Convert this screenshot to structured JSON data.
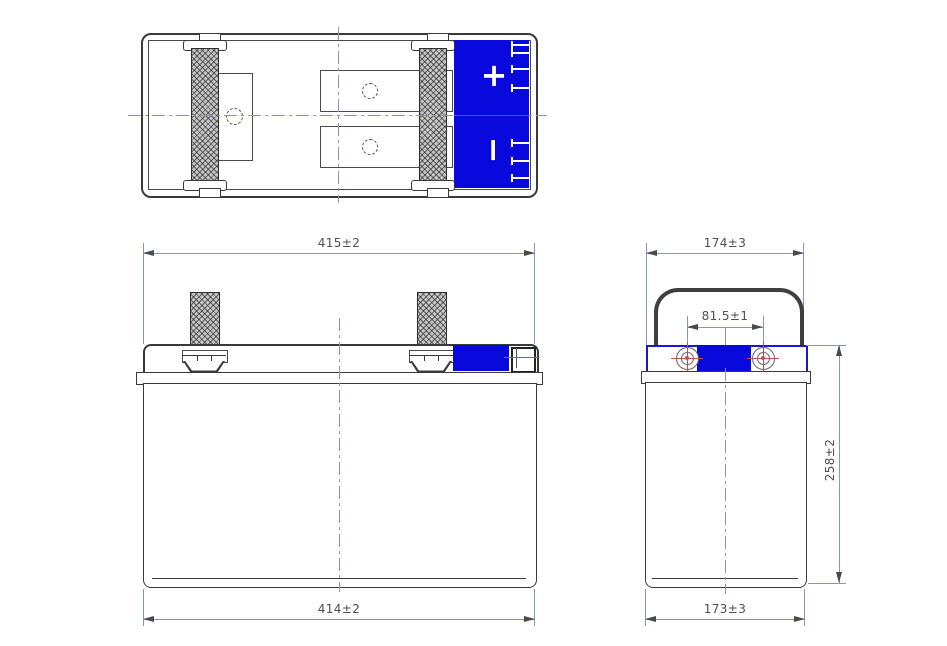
{
  "title": "Battery three-view dimensional drawing",
  "colors": {
    "line": "#3a3a3a",
    "accent_blue": "#0909dd",
    "dimension_line": "#8a92c8",
    "dimension_text": "#4f4f4f",
    "marker_red": "#c0504d"
  },
  "top_view": {
    "positive_terminal_label": "+",
    "negative_terminal_label": "−"
  },
  "front_view": {
    "overall_width": "415±2",
    "base_width": "414±2"
  },
  "side_view": {
    "overall_depth": "174±3",
    "terminal_spacing": "81.5±1",
    "overall_height": "258±2",
    "base_depth": "173±3"
  }
}
